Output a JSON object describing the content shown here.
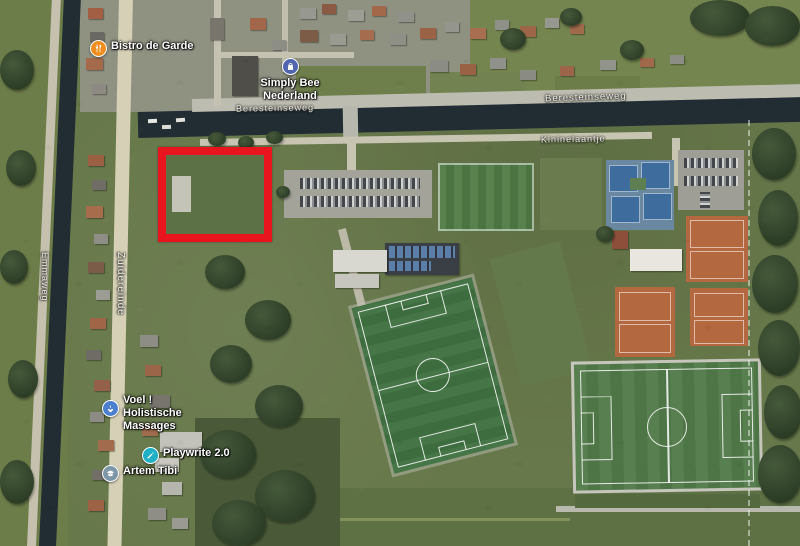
{
  "labels": {
    "pois": {
      "bistro": {
        "name": "Bistro de Garde",
        "icon": "restaurant-icon"
      },
      "simply_bee": {
        "line1": "Simply Bee",
        "line2": "Nederland",
        "icon": "shopping-bag-icon"
      },
      "voel": {
        "line1": "Voel !",
        "line2": "Holistische",
        "line3": "Massages",
        "icon": "spa-icon"
      },
      "playwrite": {
        "name": "Playwrite 2.0",
        "icon": "pencil-icon"
      },
      "artem": {
        "name": "Artem Tibi",
        "icon": "graduation-cap-icon"
      }
    },
    "roads": {
      "beresteinseweg_west": "Beresteinseweg",
      "beresteinseweg_east": "Beresteinseweg",
      "kininelaantje": "Kininelaantje",
      "zuidereinde": "Zuidereinde",
      "emmaweg": "Emmaweg"
    }
  },
  "highlight": {
    "shape": "rectangle",
    "border_color": "#e8141e"
  },
  "colors": {
    "accent_red": "#e8141e",
    "water": "#212c33",
    "turf_green": "#3f7040",
    "clay_orange": "#b4683f",
    "tennis_blue": "#3e6c9c",
    "poi_restaurant": "#ef8e1f",
    "poi_shopping": "#5065ae",
    "poi_massage": "#4d7fd1",
    "poi_business": "#1fb0c5",
    "poi_school": "#7e97a8"
  }
}
